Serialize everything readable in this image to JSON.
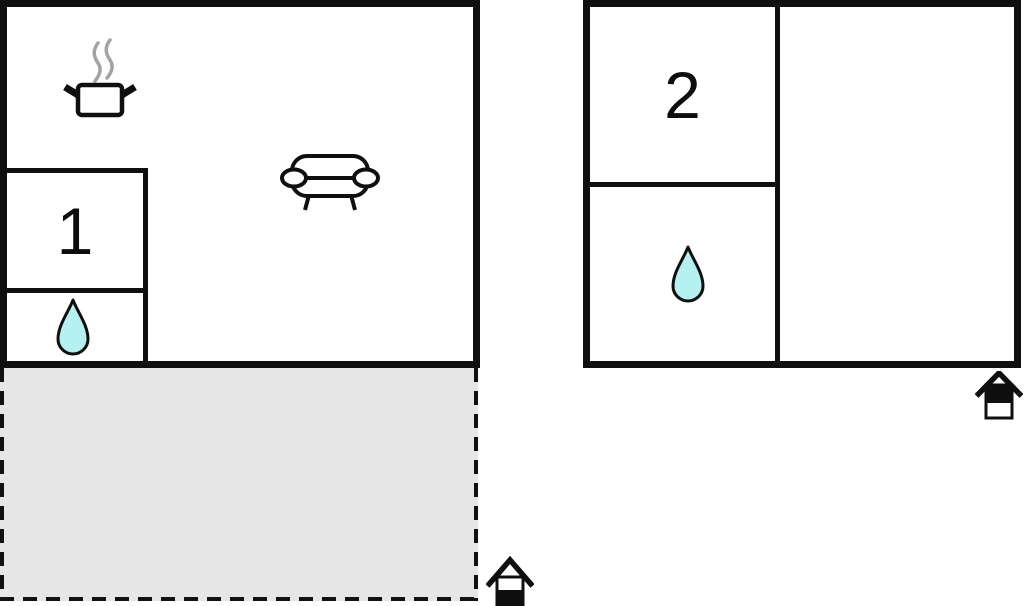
{
  "diagram": {
    "type": "vacation-home floor plan",
    "colors": {
      "wall": "#0f0f0f",
      "water_drop_fill": "#b5f1f1",
      "terrace_fill": "#e6e6e6",
      "steam": "#a3a3a3",
      "background": "#ffffff"
    },
    "left_building": {
      "room_label": "1",
      "icons": [
        "cooking-pot-icon",
        "sofa-icon",
        "water-drop-icon",
        "entrance-house-icon"
      ],
      "terrace": {
        "outline": "dashed",
        "fill": "#e6e6e6"
      }
    },
    "right_building": {
      "room_label": "2",
      "icons": [
        "water-drop-icon",
        "entrance-house-icon"
      ]
    }
  }
}
